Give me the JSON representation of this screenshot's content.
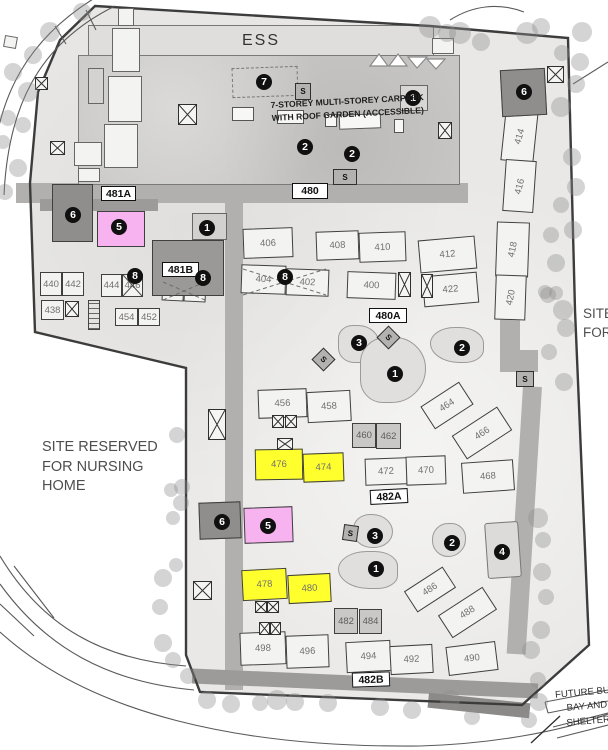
{
  "colors": {
    "highlight_yellow": "#ffff2d",
    "highlight_pink": "#f7b2f0",
    "block_fill": "#f3f3f1",
    "dark_block": "#8f8e8c",
    "road": "#b1b0ae",
    "boundary": "#3c3c3c",
    "tree": "#8f8f8f"
  },
  "texts": {
    "ess": "ESS",
    "carpark_line1": "7-STOREY MULTI-STOREY CARPARK",
    "carpark_line2": "WITH ROOF GARDEN (ACCESSIBLE)",
    "nursing_line1": "SITE RESERVED",
    "nursing_line2": "FOR NURSING",
    "nursing_line3": "HOME",
    "right_edge_line1": "SITE",
    "right_edge_line2": "FOR",
    "future_line1": "FUTURE BUS",
    "future_line2": "BAY AND",
    "future_line3": "SHELTER",
    "substation": "S"
  },
  "road_labels": {
    "r480": "480",
    "r481A": "481A",
    "r481B": "481B",
    "r480A": "480A",
    "r482A": "482A",
    "r482B": "482B"
  },
  "markers": {
    "n1": "1",
    "n2": "2",
    "n3": "3",
    "n4": "4",
    "n5": "5",
    "n6": "6",
    "n7": "7",
    "n8": "8"
  },
  "blocks": {
    "400": "400",
    "402": "402",
    "404": "404",
    "406": "406",
    "408": "408",
    "410": "410",
    "412": "412",
    "414": "414",
    "416": "416",
    "418": "418",
    "420": "420",
    "422": "422",
    "438": "438",
    "440": "440",
    "442": "442",
    "444": "444",
    "446": "446",
    "448": "448",
    "450": "450",
    "452": "452",
    "454": "454",
    "456": "456",
    "458": "458",
    "460": "460",
    "462": "462",
    "464": "464",
    "466": "466",
    "468": "468",
    "470": "470",
    "472": "472",
    "474": "474",
    "476": "476",
    "478": "478",
    "480": "480",
    "482": "482",
    "484": "484",
    "486": "486",
    "488": "488",
    "490": "490",
    "492": "492",
    "494": "494",
    "496": "496",
    "498": "498"
  }
}
